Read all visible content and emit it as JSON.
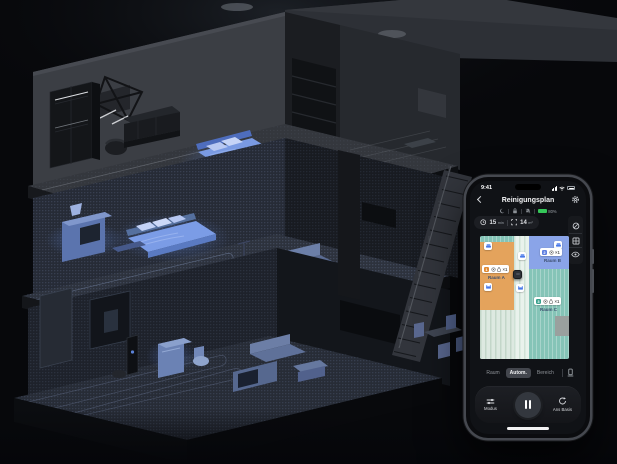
{
  "scene": {
    "background_color": "#07080b",
    "illustration": "isometric-cutaway-smart-home-with-robot-vacuum-paths",
    "accent_blue": "#7b9ce6"
  },
  "phone": {
    "status_bar": {
      "time": "9:41",
      "icons": [
        "signal-icon",
        "wifi-icon",
        "battery-icon"
      ]
    },
    "header": {
      "title": "Reinigungsplan",
      "back_icon": "chevron-left-icon",
      "settings_icon": "gear-icon"
    },
    "device_status": {
      "icons": [
        "dnd-moon-icon",
        "lock-icon",
        "mute-icon"
      ],
      "battery_percent": "80%",
      "battery_color": "#35c759"
    },
    "stats": {
      "time_value": "15",
      "time_unit": "min",
      "area_value": "14",
      "area_unit": "m²"
    },
    "map_tools": {
      "items": [
        "no-go-zone-icon",
        "split-room-icon",
        "map-view-icon"
      ]
    },
    "map": {
      "rooms": [
        {
          "name": "Raum A",
          "order": "1",
          "multiplier": "×1",
          "color": "#e4a35c",
          "chip_color": "#e08a33"
        },
        {
          "name": "Raum B",
          "order": "2",
          "multiplier": "×1",
          "color": "#8aa4e8",
          "chip_color": "#5f7fe0"
        },
        {
          "name": "Raum C",
          "order": "3",
          "multiplier": "×1",
          "color": "#85c4b7",
          "chip_color": "#38a08c"
        }
      ]
    },
    "tabs": {
      "items": [
        {
          "label": "Raum"
        },
        {
          "label": "Autom."
        },
        {
          "label": "Bereich"
        }
      ],
      "selected": "Autom."
    },
    "controls": {
      "mode_label": "Modus",
      "dock_label": "Ans Basis",
      "center_icon": "pause-icon"
    }
  }
}
